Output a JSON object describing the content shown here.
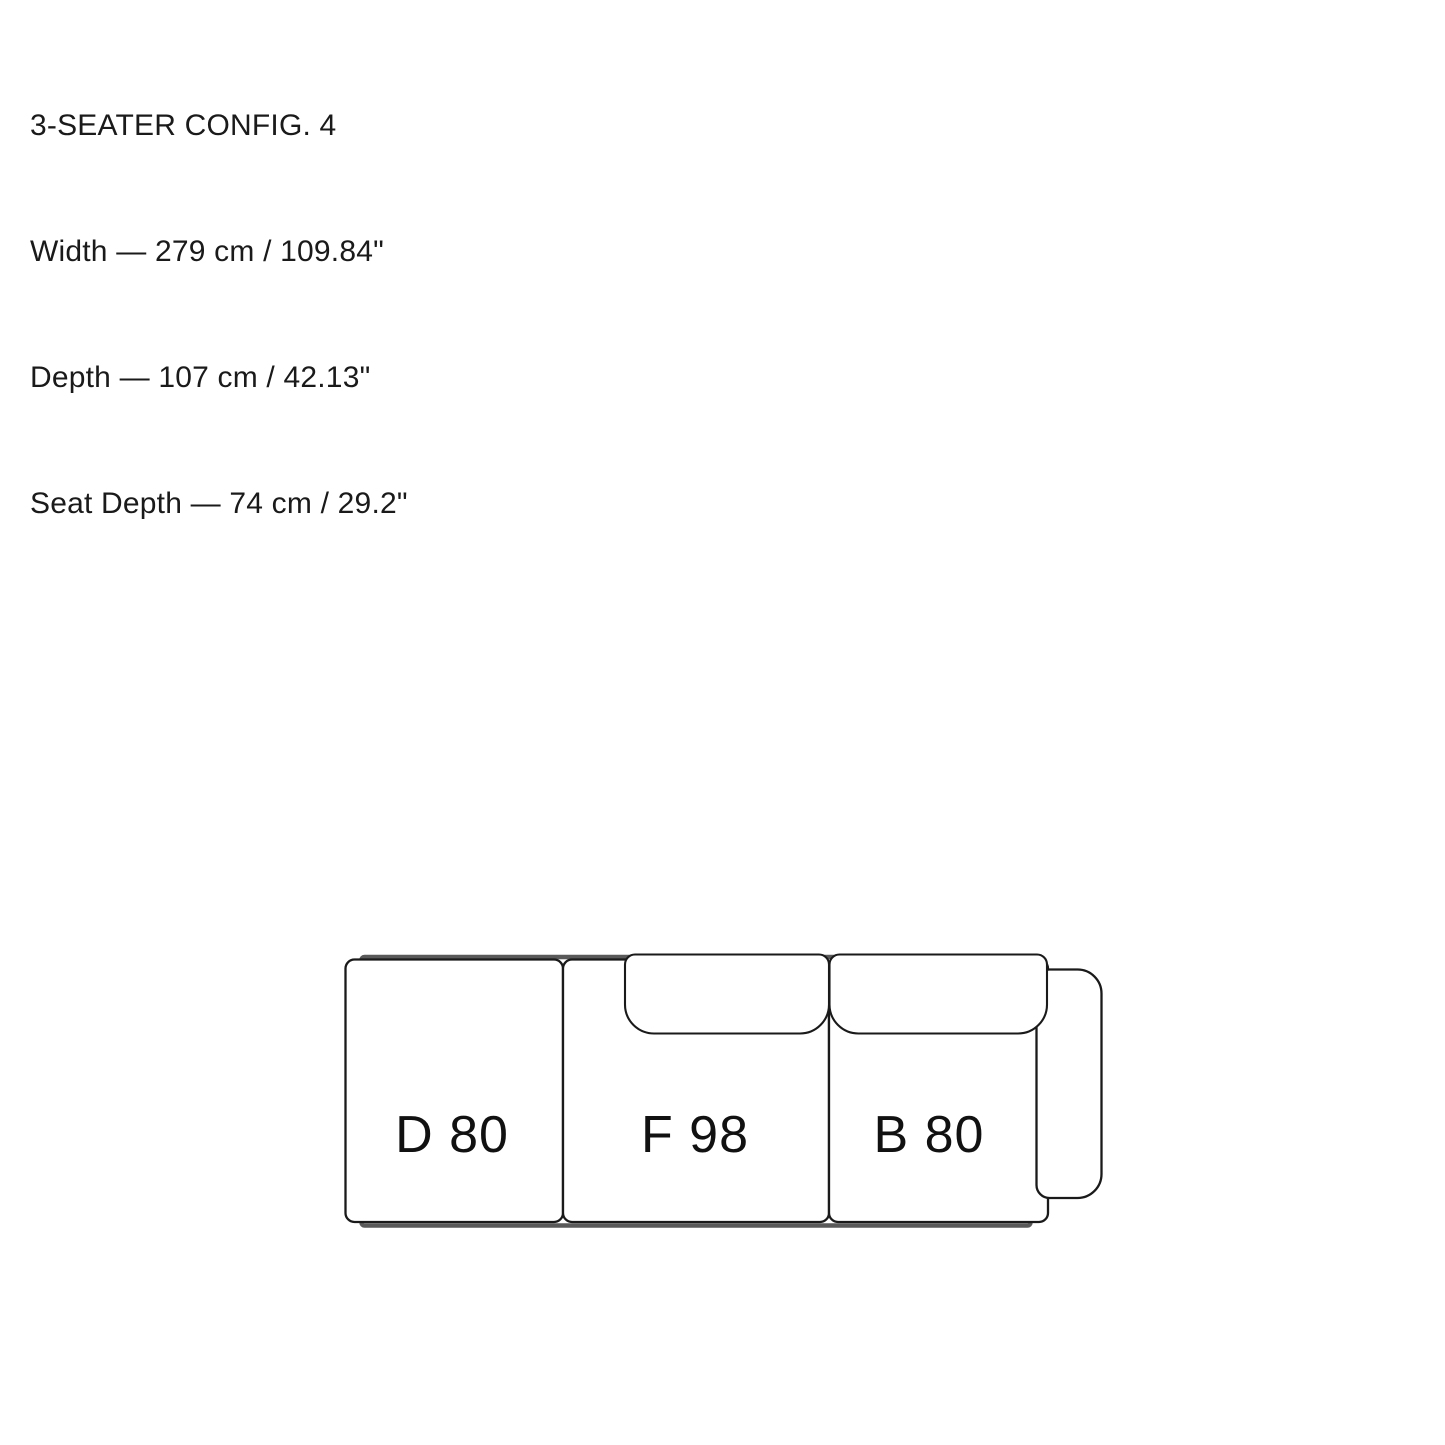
{
  "specs": {
    "title": "3-SEATER CONFIG. 4",
    "width": "Width — 279 cm / 109.84\"",
    "depth": "Depth — 107 cm / 42.13\"",
    "seat_depth": "Seat Depth — 74 cm / 29.2\""
  },
  "diagram": {
    "type": "sofa-top-view-3-seater",
    "modules": [
      {
        "id": "D80",
        "label": "D 80"
      },
      {
        "id": "F98",
        "label": "F 98"
      },
      {
        "id": "B80",
        "label": "B 80"
      }
    ],
    "armrest_side": "right",
    "colors": {
      "outline": "#1a1a1a",
      "frame": "#595959",
      "fill": "#ffffff",
      "label": "#111111"
    }
  }
}
